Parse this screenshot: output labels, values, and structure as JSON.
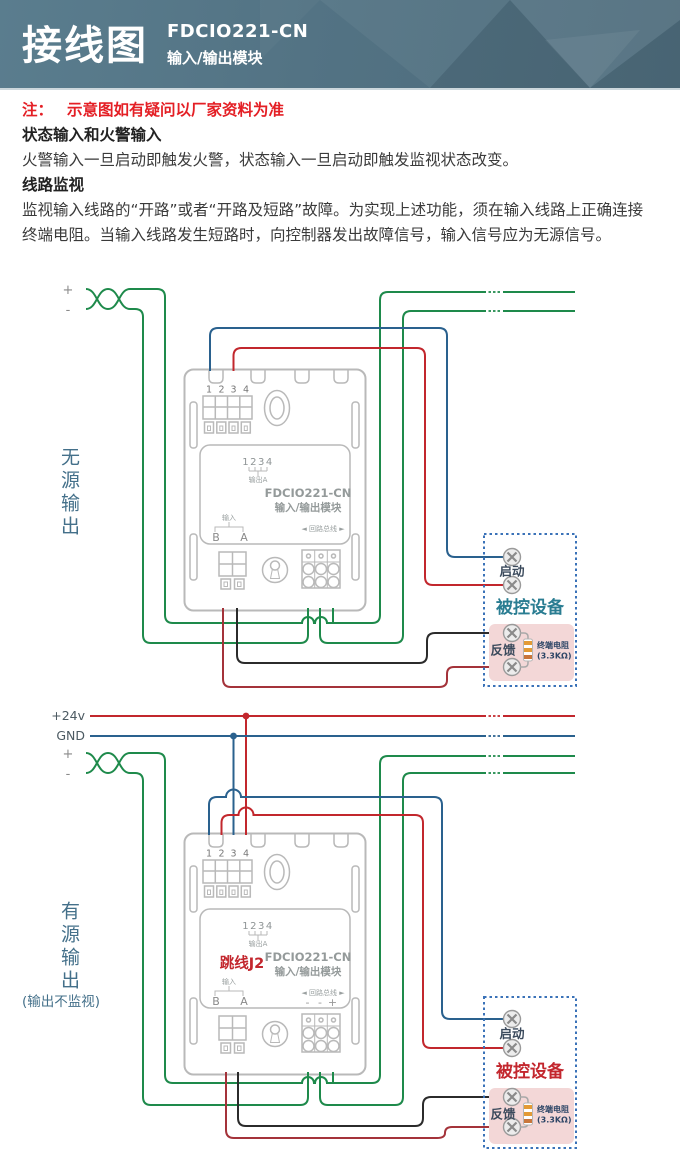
{
  "header": {
    "title": "接线图",
    "model": "FDCIO221-CN",
    "subtitle": "输入/输出模块"
  },
  "note": {
    "label": "注：",
    "text": "示意图如有疑问以厂家资料为准"
  },
  "sections": [
    {
      "heading": "状态输入和火警输入",
      "body": "火警输入一旦启动即触发火警，状态输入一旦启动即触发监视状态改变。"
    },
    {
      "heading": "线路监视",
      "body": "监视输入线路的“开路”或者“开路及短路”故障。为实现上述功能，须在输入线路上正确连接终端电阻。当输入线路发生短路时，向控制器发出故障信号，输入信号应为无源信号。"
    }
  ],
  "module": {
    "terminals": [
      "1",
      "2",
      "3",
      "4"
    ],
    "output_numbers": "1234",
    "output_label": "输出A",
    "title": "FDCIO221-CN",
    "subtitle": "输入/输出模块",
    "input_label": "输入",
    "input_b": "B",
    "input_a": "A",
    "loop_bus": "◄ 回路总线 ►"
  },
  "top": {
    "side_label": "无源输出",
    "plus": "+",
    "minus": "-",
    "device_title": "被控设备",
    "start_label": "启动",
    "feedback_label": "反馈",
    "resistor_name": "终端电阻",
    "resistor_value": "(3.3KΩ)"
  },
  "bottom": {
    "side_label": "有源输出",
    "side_note": "(输出不监视)",
    "power": "+24v",
    "gnd": "GND",
    "plus": "+",
    "minus": "-",
    "jumper": "跳线J2",
    "polarity": [
      "-",
      "-",
      "+"
    ],
    "device_title": "被控设备",
    "start_label": "启动",
    "feedback_label": "反馈",
    "resistor_name": "终端电阻",
    "resistor_value": "(3.3KΩ)"
  },
  "colors": {
    "header_bg": "#537384",
    "loop_green": "#1e8a4b",
    "signal_red": "#c2272d",
    "feedback_maroon": "#a4333a",
    "signal_blue": "#2a618e",
    "device_title_top": "#2a7d92",
    "device_title_bottom": "#c3272e",
    "device_box_border": "#3a72b8",
    "pink_panel": "#f3d7d7",
    "module_outline": "#b9b9b9"
  }
}
